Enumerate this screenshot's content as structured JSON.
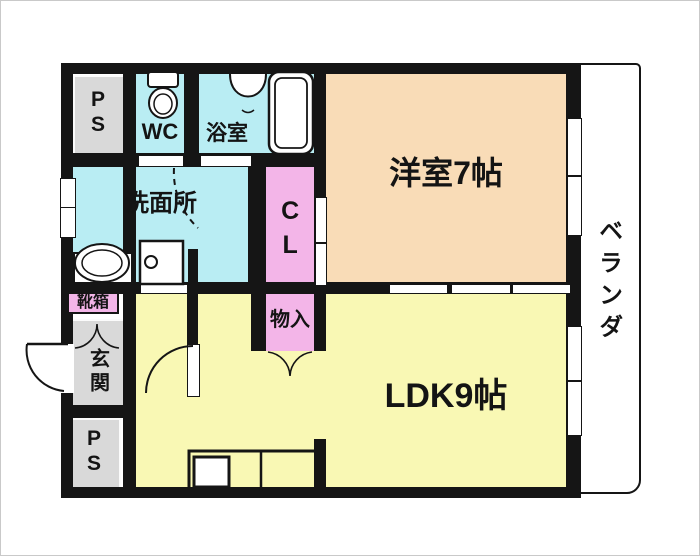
{
  "floorplan": {
    "type": "apartment-floor-plan",
    "rooms": {
      "ps_top": {
        "label": "PS"
      },
      "wc": {
        "label": "WC"
      },
      "bath": {
        "label": "浴室"
      },
      "washroom": {
        "label": "洗面所"
      },
      "closet": {
        "label": "CL"
      },
      "western_room": {
        "label": "洋室7帖"
      },
      "storage": {
        "label": "物入"
      },
      "shoe_box": {
        "label": "靴箱"
      },
      "entrance": {
        "label": "玄関"
      },
      "ps_bottom": {
        "label": "PS"
      },
      "ldk": {
        "label": "LDK9帖"
      },
      "veranda": {
        "label": "ベランダ"
      }
    },
    "colors": {
      "wet_area": "#b9edf3",
      "closet": "#f3b5e8",
      "western_room": "#f9dcb7",
      "ldk": "#f9f8b4",
      "service": "#d9d9d9",
      "wall": "#151515",
      "background": "#ffffff"
    }
  }
}
